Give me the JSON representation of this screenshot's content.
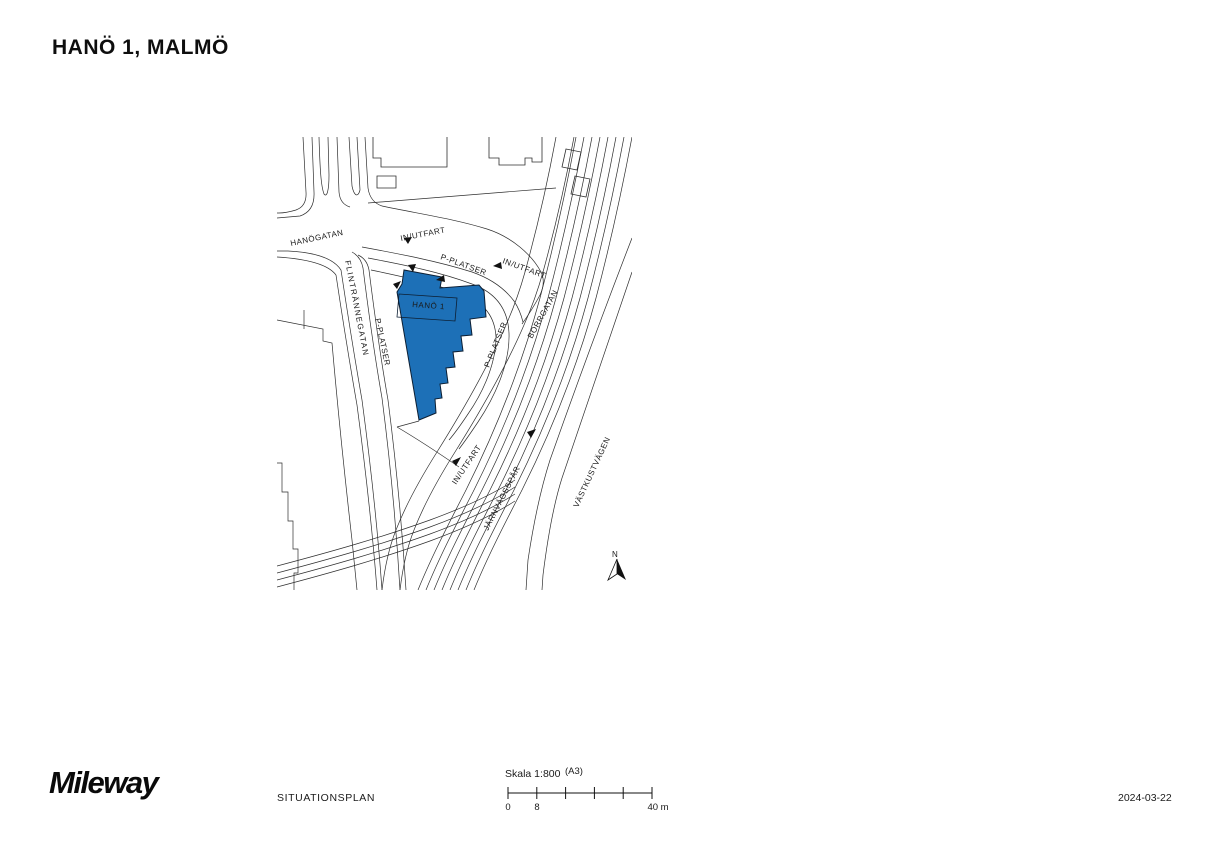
{
  "header": {
    "title": "HANÖ 1, MALMÖ"
  },
  "map": {
    "building": {
      "label": "HANÖ 1",
      "fill_color": "#1d70b7"
    },
    "road_labels": {
      "hanogatan": "HANÖGATAN",
      "flintrannegatan": "FLINTRÄNNEGATAN",
      "borrgatan": "BORRGATAN",
      "jarnvagsspar": "JÄRNVÄGSSPÅR",
      "vastkustvagen": "VÄSTKUSTVÄGEN",
      "in_utfart_top": "IN/UTFART",
      "in_utfart_east": "IN/UTFART",
      "in_utfart_south": "IN/UTFART",
      "p_platser_top": "P-PLATSER",
      "p_platser_west": "P-PLATSER",
      "p_platser_east": "P-PLATSER"
    },
    "north_label": "N"
  },
  "footer": {
    "logo_text": "Mileway",
    "drawing_title": "SITUATIONSPLAN",
    "scale": {
      "label": "Skala 1:800",
      "paper": "(A3)",
      "tick_start": "0",
      "tick_mid": "8",
      "tick_end": "40 m"
    },
    "date": "2024-03-22"
  }
}
